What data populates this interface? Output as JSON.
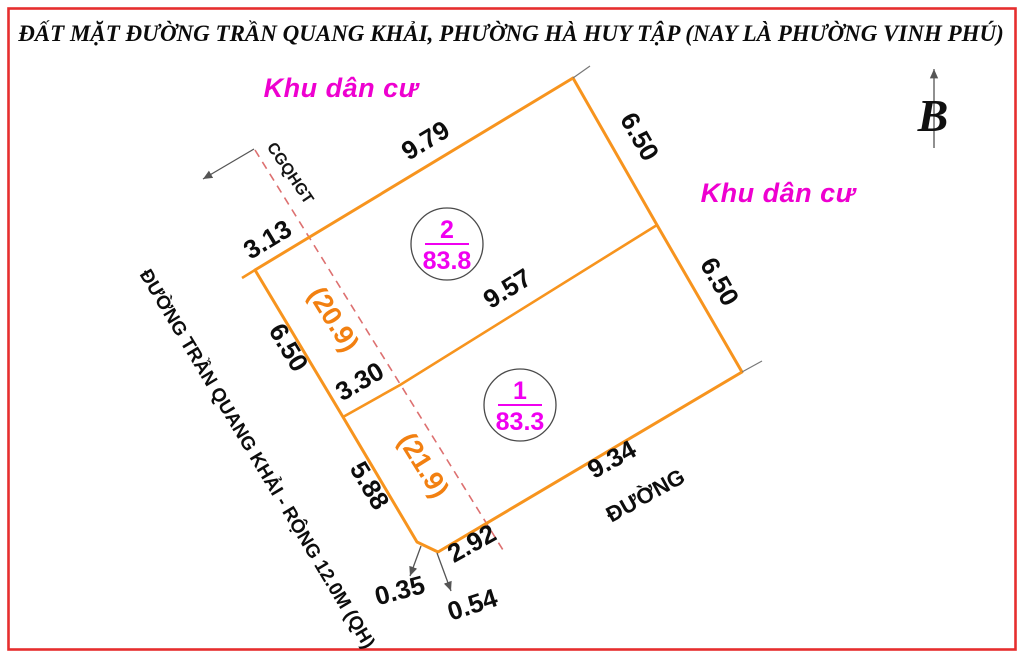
{
  "title": "ĐẤT MẶT ĐƯỜNG TRẦN QUANG KHẢI, PHƯỜNG HÀ HUY TẬP (NAY LÀ PHƯỜNG VINH PHÚ)",
  "compass": {
    "label": "B"
  },
  "zones": {
    "left": "Khu dân cư",
    "right": "Khu dân cư"
  },
  "street": {
    "main_road": "ĐƯỜNG TRẦN QUANG KHẢI - RỘNG 12.0M (QH)",
    "side_road": "ĐƯỜNG",
    "planning_boundary": "CGQHGT"
  },
  "plots": [
    {
      "number": "1",
      "area": "83.3"
    },
    {
      "number": "2",
      "area": "83.8"
    }
  ],
  "dimensions": {
    "top_left_edge": "9.79",
    "right_edge_upper": "6.50",
    "right_edge_lower": "6.50",
    "left_offcut": "3.13",
    "left_edge_upper": "6.50",
    "divider_left": "3.30",
    "divider_right": "9.57",
    "left_edge_lower": "5.88",
    "bottom_edge": "9.34",
    "bottom_edge_end": "2.92",
    "chamfer_left": "0.35",
    "chamfer_right": "0.54",
    "planning_strip_upper": "(20.9)",
    "planning_strip_lower": "(21.9)"
  },
  "colors": {
    "parcel_line": "#f7941e",
    "planning_dim_text": "#f28011",
    "zone_text": "#ee00d0",
    "plot_text": "#f000f0",
    "dashed_line": "#dd7070",
    "border_red": "#e62e2e"
  }
}
